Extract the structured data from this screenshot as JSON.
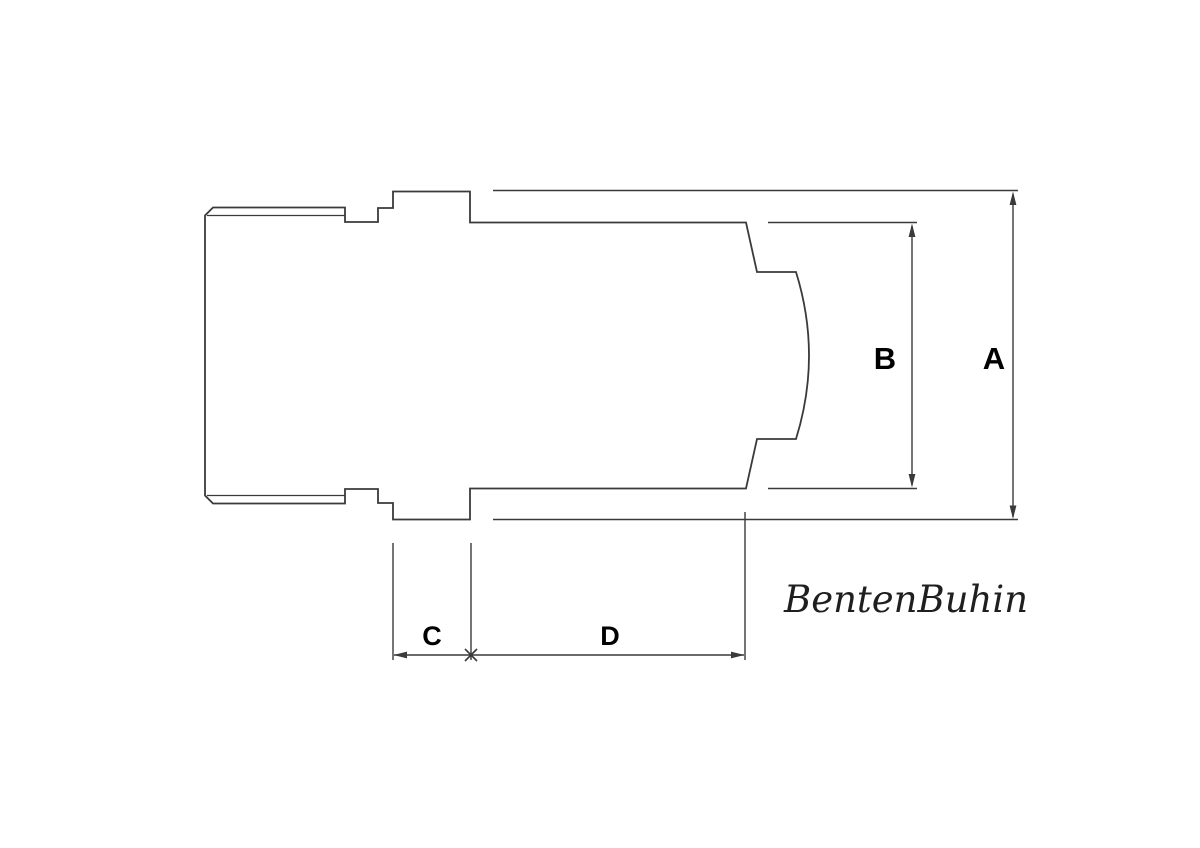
{
  "drawing": {
    "line_color": "#3a3a3a",
    "label_color": "#000000",
    "logo_color": "#1f1f1f",
    "dimension_labels": {
      "a": "A",
      "b": "B",
      "c": "C",
      "d": "D"
    },
    "logo_text": "BentenBuhin"
  }
}
